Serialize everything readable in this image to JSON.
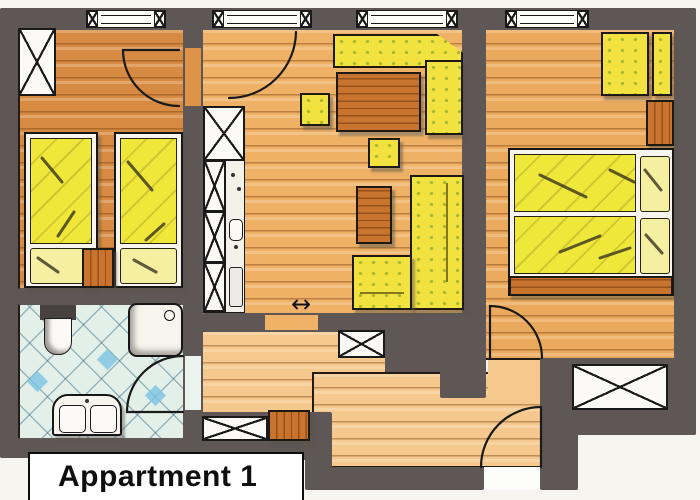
{
  "title": {
    "label": "Appartment 1"
  },
  "symbols": {
    "passage_arrow": "↔"
  },
  "colors": {
    "wall": "#5f5755",
    "floor_left_bedroom": "#d68a42",
    "floor_living": "#efb166",
    "floor_right_bedroom": "#eaa95c",
    "floor_hall": "#f5c98e",
    "bath_tile": "#e3f0ea",
    "tile_accent": "#7ac4e4",
    "furniture_yellow": "#f2e23f",
    "pillow_yellow": "#f5efa2",
    "wood": "#c8732e",
    "fixture_white": "#f7f5ee"
  },
  "rooms": [
    {
      "id": "bedroom-left",
      "furniture": [
        "wardrobe",
        "single-bed",
        "single-bed",
        "nightstand"
      ]
    },
    {
      "id": "bathroom",
      "furniture": [
        "toilet",
        "shower",
        "double-washbasin"
      ]
    },
    {
      "id": "living-room",
      "furniture": [
        "kitchenette",
        "corner-bench",
        "dining-table",
        "stool",
        "stool",
        "corner-sofa",
        "coffee-table"
      ]
    },
    {
      "id": "bedroom-right",
      "furniture": [
        "armchair",
        "side-table",
        "double-bed",
        "nightstand"
      ]
    },
    {
      "id": "hallway",
      "furniture": [
        "wardrobe",
        "shoe-cabinet"
      ]
    }
  ],
  "counts": {
    "windows": 6,
    "door_swings": 5
  }
}
